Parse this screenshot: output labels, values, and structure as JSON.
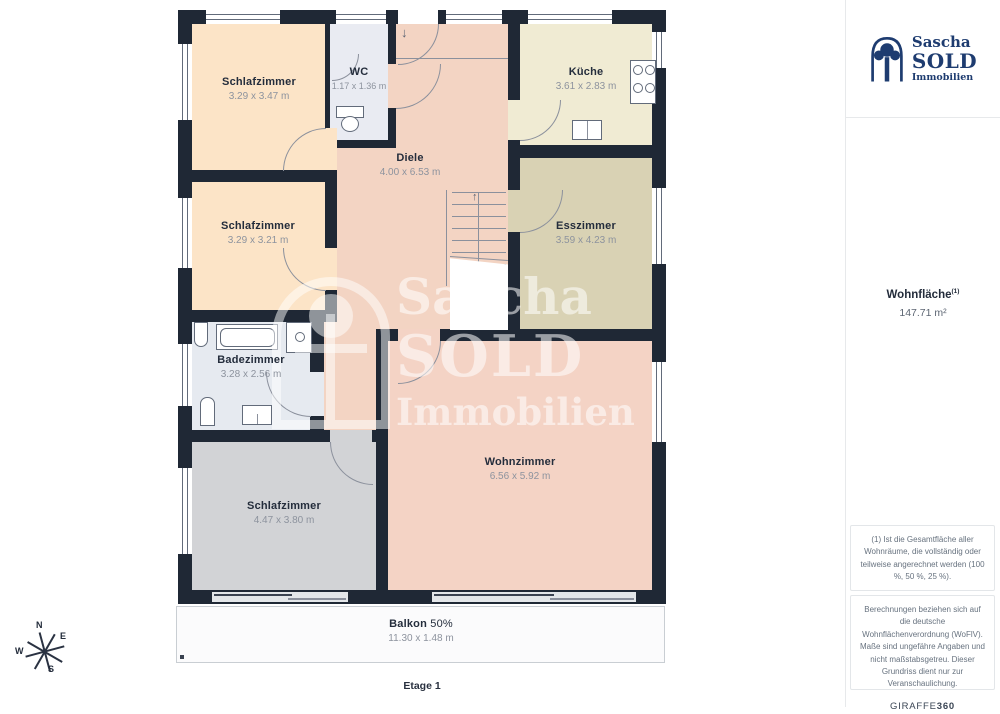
{
  "branding": {
    "name_top": "Sascha",
    "name_mid": "SOLD",
    "name_bottom": "Immobilien"
  },
  "sidebar": {
    "area_label": "Wohnfläche",
    "area_sup": "(1)",
    "area_value": "147.71 m²",
    "note1": "(1) Ist die Gesamtfläche aller Wohnräume, die vollständig oder teilweise angerechnet werden (100 %, 50 %, 25 %).",
    "note2": "Berechnungen beziehen sich auf die deutsche Wohnflächenverordnung (WoFlV). Maße sind ungefähre Angaben und nicht maßstabsgetreu. Dieser Grundriss dient nur zur Veranschaulichung.",
    "brand": "GIRAFFE",
    "brand_suffix": "360"
  },
  "floorplan": {
    "floor_label": "Etage 1",
    "compass": {
      "n": "N",
      "e": "E",
      "s": "S",
      "w": "W"
    },
    "icons": {
      "entrance_arrow": "↓",
      "stairs_arrow": "↑"
    },
    "watermark": {
      "line1": "Sascha",
      "line2": "SOLD",
      "line3": "Immobilien"
    },
    "rooms": [
      {
        "name": "Schlafzimmer",
        "dims": "3.29 x 3.47 m"
      },
      {
        "name": "WC",
        "dims": "1.17 x 1.36 m"
      },
      {
        "name": "Küche",
        "dims": "3.61 x 2.83 m"
      },
      {
        "name": "Diele",
        "dims": "4.00 x 6.53 m"
      },
      {
        "name": "Schlafzimmer",
        "dims": "3.29 x 3.21 m"
      },
      {
        "name": "Esszimmer",
        "dims": "3.59 x 4.23 m"
      },
      {
        "name": "Badezimmer",
        "dims": "3.28 x 2.56 m"
      },
      {
        "name": "Wohnzimmer",
        "dims": "6.56 x 5.92 m"
      },
      {
        "name": "Schlafzimmer",
        "dims": "4.47 x 3.80 m"
      },
      {
        "name": "Balkon",
        "percent": "50%",
        "dims": "11.30 x 1.48 m"
      }
    ],
    "colors": {
      "wall": "#1F2835",
      "bedroom": "#FCE4C7",
      "hall": "#F3D4C3",
      "kitchen": "#F0EBD3",
      "dining": "#D9D2B4",
      "bath": "#E6EAF0",
      "wc": "#E9EBF2",
      "bedroom_gray": "#D2D3D6",
      "living": "#F4D3C5",
      "brand_navy": "#1E3C70"
    }
  }
}
